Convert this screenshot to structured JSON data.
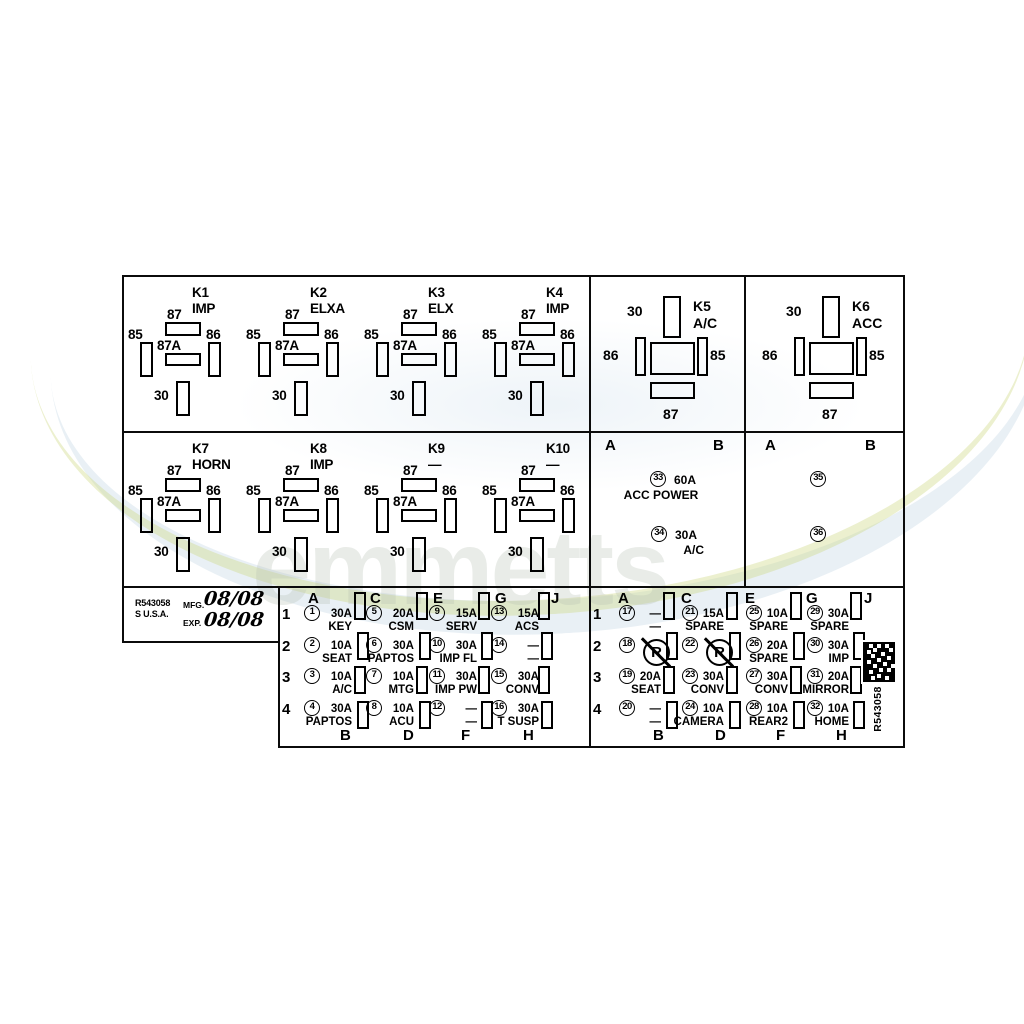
{
  "watermark": {
    "text": "emmetts"
  },
  "pin_labels": {
    "p87": "87",
    "p87a": "87A",
    "p85": "85",
    "p86": "86",
    "p30": "30"
  },
  "relay_grid": {
    "row1": [
      {
        "id": "K1",
        "name": "IMP"
      },
      {
        "id": "K2",
        "name": "ELXA"
      },
      {
        "id": "K3",
        "name": "ELX"
      },
      {
        "id": "K4",
        "name": "IMP"
      }
    ],
    "row2": [
      {
        "id": "K7",
        "name": "HORN"
      },
      {
        "id": "K8",
        "name": "IMP"
      },
      {
        "id": "K9",
        "name": "—"
      },
      {
        "id": "K10",
        "name": "—"
      }
    ]
  },
  "big_relays": [
    {
      "id": "K5",
      "name": "A/C"
    },
    {
      "id": "K6",
      "name": "ACC"
    }
  ],
  "maxi_left": {
    "col_a": "A",
    "col_b": "B",
    "fuse1": {
      "num": "33",
      "amp": "60A",
      "name": "ACC POWER"
    },
    "fuse2": {
      "num": "34",
      "amp": "30A",
      "name": "A/C"
    }
  },
  "maxi_right": {
    "col_a": "A",
    "col_b": "B",
    "fuse1": {
      "num": "35"
    },
    "fuse2": {
      "num": "36"
    }
  },
  "label_box": {
    "part_number": "R543058",
    "origin": "S U.S.A.",
    "mfg_label": "MFG.",
    "mfg_value": "08/08",
    "exp_label": "EXP.",
    "exp_value": "08/08"
  },
  "grid_left": {
    "row_numbers": [
      "1",
      "2",
      "3",
      "4"
    ],
    "top_letters": [
      "A",
      "C",
      "E",
      "G",
      "J"
    ],
    "bottom_letters": [
      "B",
      "D",
      "F",
      "H"
    ],
    "cells": [
      [
        {
          "num": "1",
          "amp": "30A",
          "name": "KEY"
        },
        {
          "num": "5",
          "amp": "20A",
          "name": "CSM"
        },
        {
          "num": "9",
          "amp": "15A",
          "name": "SERV"
        },
        {
          "num": "13",
          "amp": "15A",
          "name": "ACS"
        }
      ],
      [
        {
          "num": "2",
          "amp": "10A",
          "name": "SEAT"
        },
        {
          "num": "6",
          "amp": "30A",
          "name": "PAPTOS"
        },
        {
          "num": "10",
          "amp": "30A",
          "name": "IMP FL"
        },
        {
          "num": "14",
          "amp": "—",
          "name": "—"
        }
      ],
      [
        {
          "num": "3",
          "amp": "10A",
          "name": "A/C"
        },
        {
          "num": "7",
          "amp": "10A",
          "name": "MTG"
        },
        {
          "num": "11",
          "amp": "30A",
          "name": "IMP PW"
        },
        {
          "num": "15",
          "amp": "30A",
          "name": "CONV"
        }
      ],
      [
        {
          "num": "4",
          "amp": "30A",
          "name": "PAPTOS"
        },
        {
          "num": "8",
          "amp": "10A",
          "name": "ACU"
        },
        {
          "num": "12",
          "amp": "—",
          "name": "—"
        },
        {
          "num": "16",
          "amp": "30A",
          "name": "T SUSP"
        }
      ]
    ]
  },
  "grid_right": {
    "row_numbers": [
      "1",
      "2",
      "3",
      "4"
    ],
    "top_letters": [
      "A",
      "C",
      "E",
      "G",
      "J"
    ],
    "bottom_letters": [
      "B",
      "D",
      "F",
      "H"
    ],
    "cells": [
      [
        {
          "num": "17",
          "amp": "—",
          "name": "—"
        },
        {
          "num": "21",
          "amp": "15A",
          "name": "SPARE"
        },
        {
          "num": "25",
          "amp": "10A",
          "name": "SPARE"
        },
        {
          "num": "29",
          "amp": "30A",
          "name": "SPARE"
        }
      ],
      [
        {
          "num": "18",
          "symbol": "R"
        },
        {
          "num": "22",
          "symbol": "R"
        },
        {
          "num": "26",
          "amp": "20A",
          "name": "SPARE"
        },
        {
          "num": "30",
          "amp": "30A",
          "name": "IMP"
        }
      ],
      [
        {
          "num": "19",
          "amp": "20A",
          "name": "SEAT"
        },
        {
          "num": "23",
          "amp": "30A",
          "name": "CONV"
        },
        {
          "num": "27",
          "amp": "30A",
          "name": "CONV"
        },
        {
          "num": "31",
          "amp": "20A",
          "name": "MIRROR"
        }
      ],
      [
        {
          "num": "20",
          "amp": "—",
          "name": "—"
        },
        {
          "num": "24",
          "amp": "10A",
          "name": "CAMERA"
        },
        {
          "num": "28",
          "amp": "10A",
          "name": "REAR2"
        },
        {
          "num": "32",
          "amp": "10A",
          "name": "HOME"
        }
      ]
    ]
  },
  "barcode": {
    "label": "R543058"
  }
}
